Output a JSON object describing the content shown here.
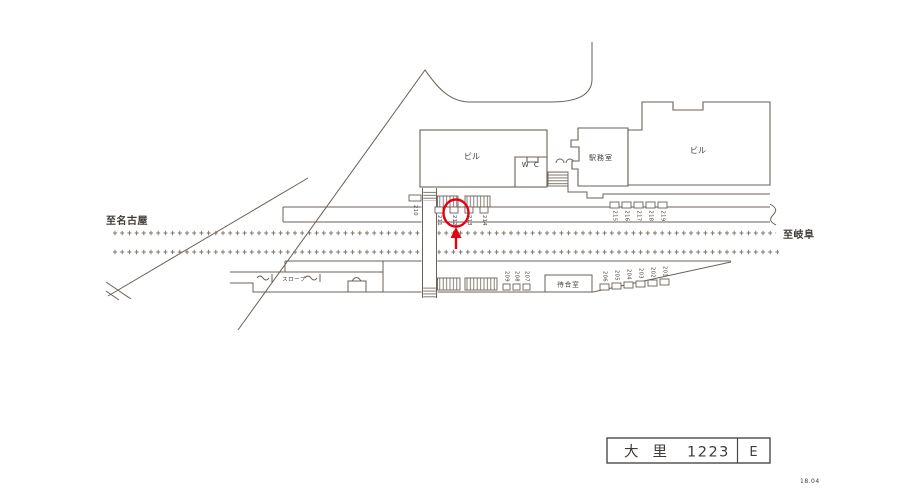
{
  "diagram": {
    "direction_left": "至名古屋",
    "direction_right": "至岐阜",
    "building_left": "ビル",
    "building_right": "ビル",
    "station_office": "駅務室",
    "toilet": "W C",
    "waiting_room": "待合室",
    "slope": "スロープ"
  },
  "ad_positions": {
    "top_row": [
      "210",
      "211",
      "212",
      "213",
      "214",
      "215",
      "216",
      "217",
      "218",
      "219"
    ],
    "bottom_row": [
      "209",
      "208",
      "207",
      "206",
      "205",
      "204",
      "203",
      "202",
      "201"
    ],
    "highlighted": "212"
  },
  "title_block": {
    "station_name": "大里",
    "location_number": "1223",
    "size_class": "E"
  },
  "revision_date": "18.04",
  "colors": {
    "line": "#6b6157",
    "text": "#3f3a35",
    "highlight": "#e60012"
  }
}
